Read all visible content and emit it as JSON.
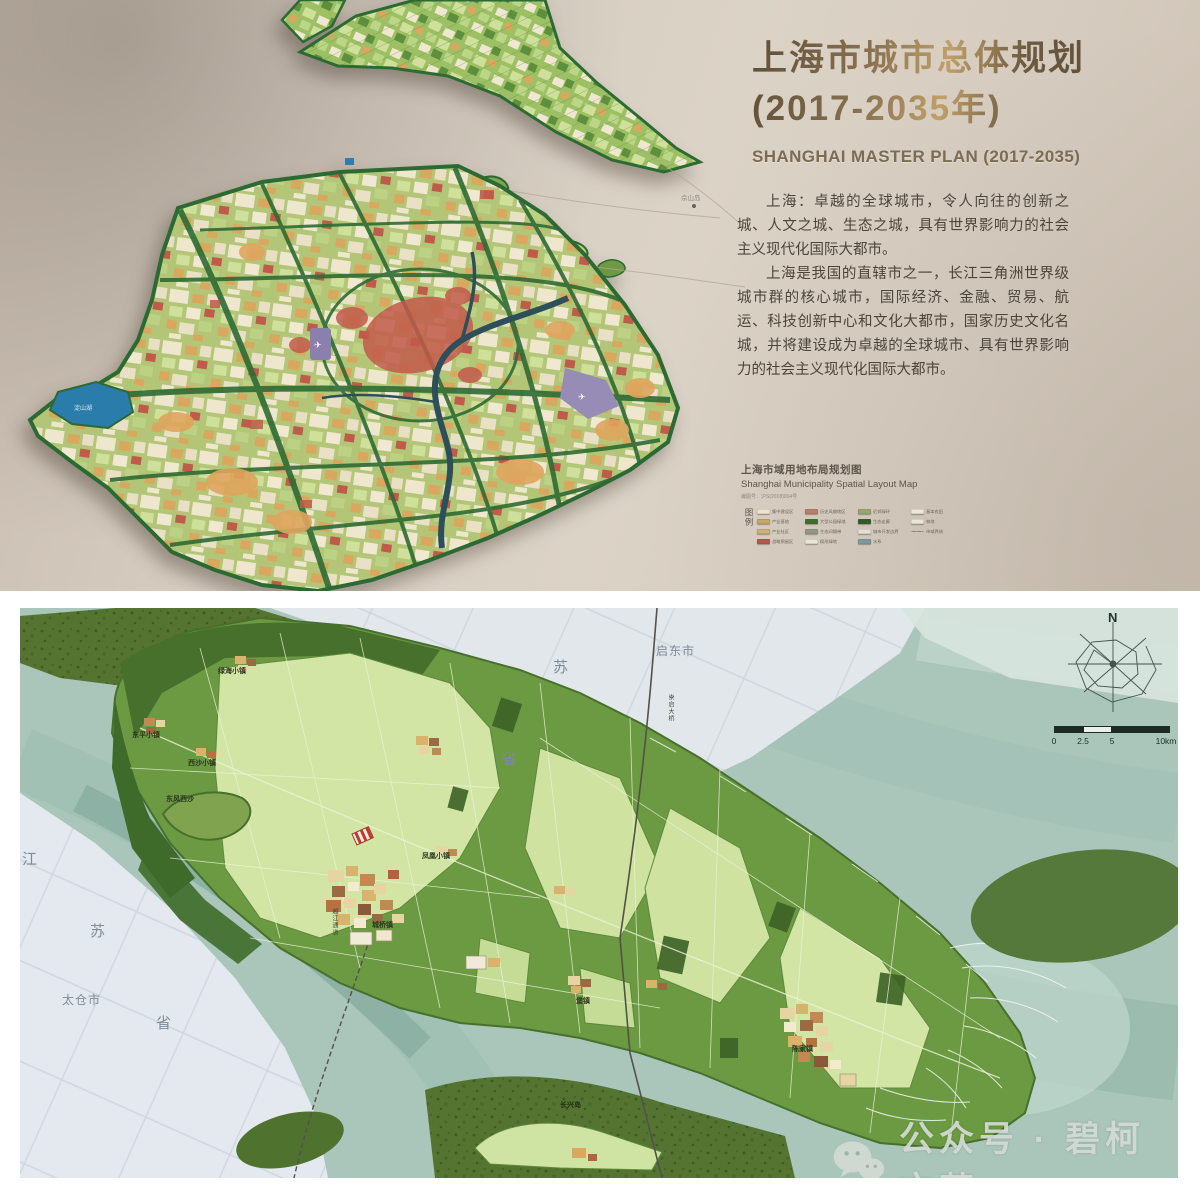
{
  "top": {
    "title_line1": "上海市城市总体规划",
    "title_line2": "(2017-2035年)",
    "title_en": "SHANGHAI MASTER PLAN (2017-2035)",
    "paragraphs": [
      "上海：卓越的全球城市，令人向往的创新之城、人文之城、生态之城，具有世界影响力的社会主义现代化国际大都市。",
      "上海是我国的直辖市之一，长江三角洲世界级城市群的核心城市，国际经济、金融、贸易、航运、科技创新中心和文化大都市，国家历史文化名城，并将建设成为卓越的全球城市、具有世界影响力的社会主义现代化国际大都市。"
    ],
    "island_label": "佘山岛",
    "lake_label": "淀山湖",
    "legend": {
      "title_cn": "上海市域用地布局规划图",
      "title_en": "Shanghai Municipality Spatial Layout Map",
      "sheet_no": "编图号：沪S(2018)004号",
      "legend_label": "图例",
      "columns": [
        [
          {
            "c": "#ece4cd",
            "t": "集中建设区"
          },
          {
            "c": "#c7a469",
            "t": "产业基地"
          },
          {
            "c": "#c9b273",
            "t": "产业社区"
          },
          {
            "c": "#b2584c",
            "t": "战略预留区"
          }
        ],
        [
          {
            "c": "#b77e6b",
            "t": "历史风貌地区"
          },
          {
            "c": "#3f6d2d",
            "t": "大型公园绿地"
          },
          {
            "c": "#8f9883",
            "t": "生态间隔带"
          },
          {
            "c": "#e7e5da",
            "t": "楔形绿地"
          }
        ],
        [
          {
            "c": "#95a769",
            "t": "近郊绿环"
          },
          {
            "c": "#2f5d2a",
            "t": "生态走廊"
          },
          {
            "c": "#e3e0d4",
            "t": "城市开发边界"
          },
          {
            "c": "#7c98a0",
            "t": "水系"
          }
        ],
        [
          {
            "c": "#ebe8dd",
            "t": "基本农田"
          },
          {
            "c": "#e8e6da",
            "t": "林地"
          },
          {
            "c": "dash",
            "t": "市域界线"
          }
        ]
      ]
    }
  },
  "bottom": {
    "compass_label": "N",
    "scale_labels": [
      "0",
      "2.5",
      "5",
      "10km"
    ],
    "place_labels": [
      {
        "t": "启东市",
        "x": 636,
        "y": 34,
        "k": "city"
      },
      {
        "t": "苏",
        "x": 533,
        "y": 48,
        "k": "prov"
      },
      {
        "t": "省",
        "x": 482,
        "y": 140,
        "k": "prov"
      },
      {
        "t": "江",
        "x": 2,
        "y": 240,
        "k": "prov"
      },
      {
        "t": "苏",
        "x": 70,
        "y": 312,
        "k": "prov"
      },
      {
        "t": "省",
        "x": 136,
        "y": 404,
        "k": "prov"
      },
      {
        "t": "太仓市",
        "x": 42,
        "y": 383,
        "k": "city"
      },
      {
        "t": "绿海小镇",
        "x": 198,
        "y": 58,
        "k": "town"
      },
      {
        "t": "东平小镇",
        "x": 112,
        "y": 122,
        "k": "town"
      },
      {
        "t": "西沙小镇",
        "x": 168,
        "y": 150,
        "k": "town"
      },
      {
        "t": "东风西沙",
        "x": 146,
        "y": 186,
        "k": "town"
      },
      {
        "t": "凤凰小镇",
        "x": 402,
        "y": 243,
        "k": "town"
      },
      {
        "t": "城桥镇",
        "x": 352,
        "y": 312,
        "k": "town"
      },
      {
        "t": "堡镇",
        "x": 556,
        "y": 388,
        "k": "town"
      },
      {
        "t": "陈家镇",
        "x": 772,
        "y": 436,
        "k": "town"
      },
      {
        "t": "长兴岛",
        "x": 540,
        "y": 492,
        "k": "town-dark"
      },
      {
        "t": "崇启大桥",
        "x": 646,
        "y": 86,
        "k": "vroad"
      },
      {
        "t": "越江通道",
        "x": 310,
        "y": 300,
        "k": "vroad"
      }
    ]
  },
  "wm": {
    "text": "公众号 · 碧柯文苑"
  }
}
